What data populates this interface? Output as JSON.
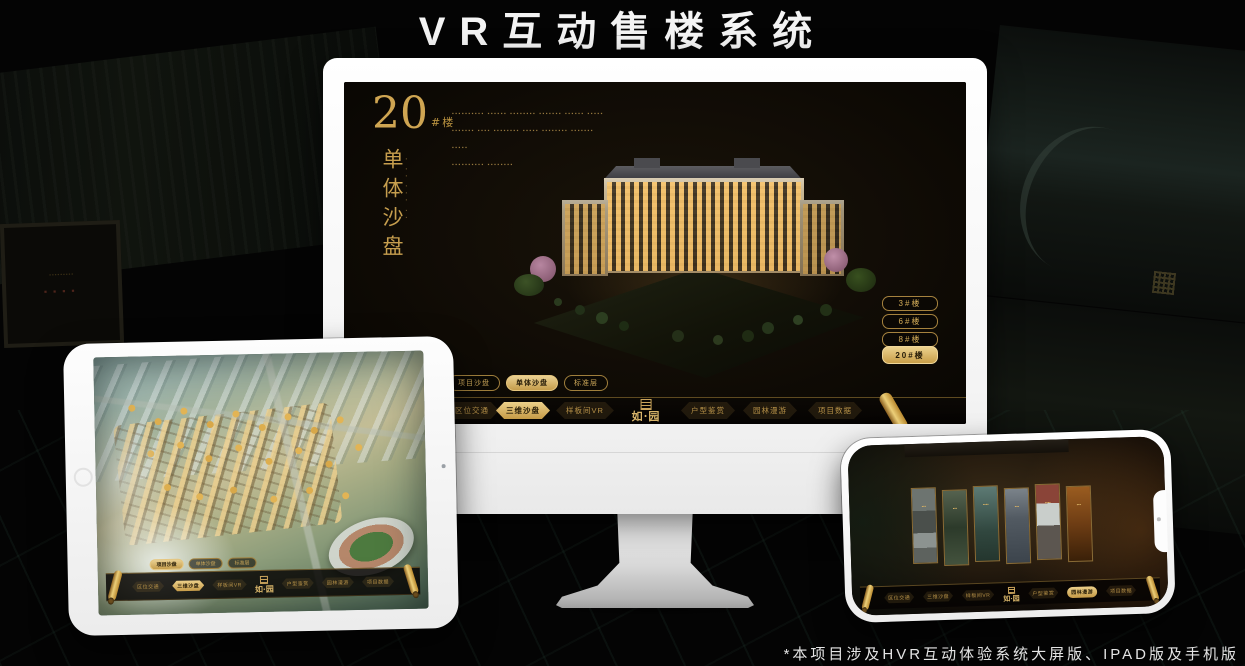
{
  "page": {
    "title": "VR互动售楼系统",
    "footnote": "*本项目涉及HVR互动体验系统大屏版、IPAD版及手机版"
  },
  "colors": {
    "accent_gold": "#c9a45c",
    "accent_gold_fill": "#d9b565",
    "selected_text": "#241a06",
    "screen_background": "#0a0805"
  },
  "ruyuan": {
    "logo_text": "如·园"
  },
  "monitor_app": {
    "title_number": "20",
    "title_suffix": "#楼",
    "subtitle_vertical": "单体沙盘",
    "subtitle_caption_illegible": "▪ ▪▪ ▪▪▪ ▪▪",
    "description_lines_illegible": [
      "▪▪▪▪▪▪▪▪▪▪ ▪▪▪▪▪▪ ▪▪▪▪▪▪▪▪ ▪▪▪▪▪▪▪ ▪▪▪▪▪▪ ▪▪▪▪▪",
      "▪▪▪▪▪▪▪ ▪▪▪▪ ▪▪▪▪▪▪▪▪ ▪▪▪▪▪ ▪▪▪▪▪▪▪▪ ▪▪▪▪▪▪▪",
      "▪▪▪▪▪",
      "▪▪▪▪▪▪▪▪▪▪ ▪▪▪▪▪▪▪▪"
    ],
    "floor_buttons": [
      {
        "label": "3#楼",
        "selected": false
      },
      {
        "label": "6#楼",
        "selected": false
      },
      {
        "label": "8#楼",
        "selected": false
      },
      {
        "label": "20#楼",
        "selected": true
      }
    ],
    "mode_tabs": [
      {
        "label": "项目沙盘",
        "selected": false
      },
      {
        "label": "单体沙盘",
        "selected": true
      },
      {
        "label": "标准层",
        "selected": false
      }
    ],
    "nav_items": [
      {
        "label": "区位交通",
        "selected": false
      },
      {
        "label": "三维沙盘",
        "selected": true
      },
      {
        "label": "样板间VR",
        "selected": false
      },
      {
        "label": "户型鉴赏",
        "selected": false
      },
      {
        "label": "园林漫游",
        "selected": false
      },
      {
        "label": "项目数据",
        "selected": false
      }
    ]
  },
  "tablet_app": {
    "mode_tabs": [
      {
        "label": "项目沙盘",
        "selected": true
      },
      {
        "label": "单体沙盘",
        "selected": false
      },
      {
        "label": "标准层",
        "selected": false
      }
    ],
    "nav_items": [
      {
        "label": "区位交通",
        "selected": false
      },
      {
        "label": "三维沙盘",
        "selected": true
      },
      {
        "label": "样板间VR",
        "selected": false
      },
      {
        "label": "户型鉴赏",
        "selected": false
      },
      {
        "label": "园林漫游",
        "selected": false
      },
      {
        "label": "项目数据",
        "selected": false
      }
    ]
  },
  "phone_app": {
    "nav_items": [
      {
        "label": "区位交通",
        "selected": false
      },
      {
        "label": "三维沙盘",
        "selected": false
      },
      {
        "label": "样板间VR",
        "selected": false
      },
      {
        "label": "户型鉴赏",
        "selected": false
      },
      {
        "label": "园林漫游",
        "selected": true
      },
      {
        "label": "项目数据",
        "selected": false
      }
    ],
    "gallery_labels_illegible": [
      "▪▪▪",
      "▪▪▪",
      "▪▪▪▪",
      "▪▪▪",
      "▪▪▪▪",
      "▪▪▪"
    ]
  },
  "background": {
    "plaque_line_illegible": "▪▪▪▪▪▪▪▪▪",
    "plaque_title_illegible": "▪▪▪▪"
  }
}
